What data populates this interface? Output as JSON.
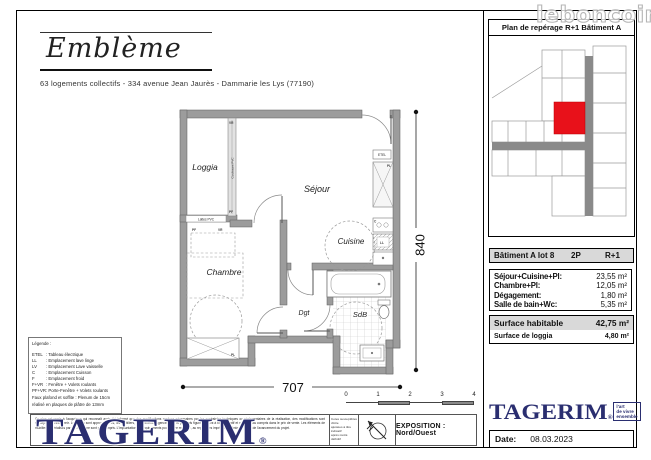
{
  "watermark": "leboncoin",
  "header": {
    "brand": "Emblème",
    "subtitle": "63 logements collectifs - 334 avenue Jean Jaurès - Dammarie les Lys (77190)"
  },
  "reperage": {
    "title": "Plan de repérage R+1 Bâtiment A"
  },
  "plan": {
    "rooms": {
      "loggia": "Loggia",
      "sejour": "Séjour",
      "cuisine": "Cuisine",
      "chambre": "Chambre",
      "dgt": "Dgt",
      "sdb": "SdB"
    },
    "labels": {
      "vr": "VR",
      "pf": "PF",
      "coulissant": "Coulissant PVC",
      "lattes": "Lattes PVC",
      "etel": "ETEL",
      "pl": "PL",
      "ll": "LL",
      "c": "C"
    },
    "dim_width": "707",
    "dim_height": "840"
  },
  "lot_table": {
    "header": {
      "title": "Bâtiment A lot 8",
      "type": "2P",
      "floor": "R+1"
    },
    "rows": [
      {
        "label": "Séjour+Cuisine+Pl:",
        "value": "23,55 m²"
      },
      {
        "label": "Chambre+Pl:",
        "value": "12,05 m²"
      },
      {
        "label": "Dégagement:",
        "value": "1,80 m²"
      },
      {
        "label": "Salle de bain+Wc:",
        "value": "5,35 m²"
      }
    ],
    "summary": [
      {
        "label": "Surface habitable",
        "value": "42,75 m²"
      },
      {
        "label": "Surface de loggia",
        "value": "4,80 m²"
      }
    ]
  },
  "legend": {
    "title": "Légende :",
    "items": [
      {
        "abbr": "ETEL",
        "desc": ": Tableau électrique"
      },
      {
        "abbr": "LL",
        "desc": ": Emplacement lave linge"
      },
      {
        "abbr": "LV",
        "desc": ": Emplacement Lave vaisselle"
      },
      {
        "abbr": "C",
        "desc": ": Emplacement Cuisson"
      },
      {
        "abbr": "F",
        "desc": ": Emplacement froid"
      },
      {
        "abbr": "F+VR",
        "desc": ": Fenêtre + Volets roulants"
      },
      {
        "abbr": "PF+VR",
        "desc": ": Porte-Fenêtre + Volets roulants"
      }
    ],
    "note1": "Faux plafond et soffite : Plenum de 15cm",
    "note2": "réalisé en plaques de plâtre de 13mm"
  },
  "footer": {
    "disclaimer": "Ce plan est remis à l'acquéreur qui reconnaît avoir été informé que des modifications rendues nécessaires par les contraintes techniques ou réglementaires de la réalisation, des modifications sont susceptibles d'intervenir. Les cotes sont approximatives, les mobiliers, équipements, agencements et placards figurés le sont à titre indicatif et ne sont pas compris dans le prix de vente. Les éléments de mobilier (matérialisés par des traits) ne sont pas compris. L'implantation des équipements pourra être modifiée, au regard des impératifs techniques, au fil de l'avancement du projet.",
    "note_lines": [
      "Cotes susceptibles d'être",
      "ajustées à titre indicatif",
      "après métré définitif"
    ],
    "exposition": "EXPOSITION : Nord/Ouest",
    "scale_ticks": [
      "0",
      "1",
      "2",
      "3",
      "4"
    ],
    "tagerim": "TAGERIM",
    "registered": "®",
    "tagline": [
      "l'art",
      "de vivre",
      "ensemble"
    ],
    "date_label": "Date:",
    "date_value": "08.03.2023"
  },
  "colors": {
    "brand_navy": "#2a2e70",
    "unit_red": "#e8111a",
    "wall_gray": "#9c9c9c",
    "table_header_bg": "#d9d9d9"
  }
}
